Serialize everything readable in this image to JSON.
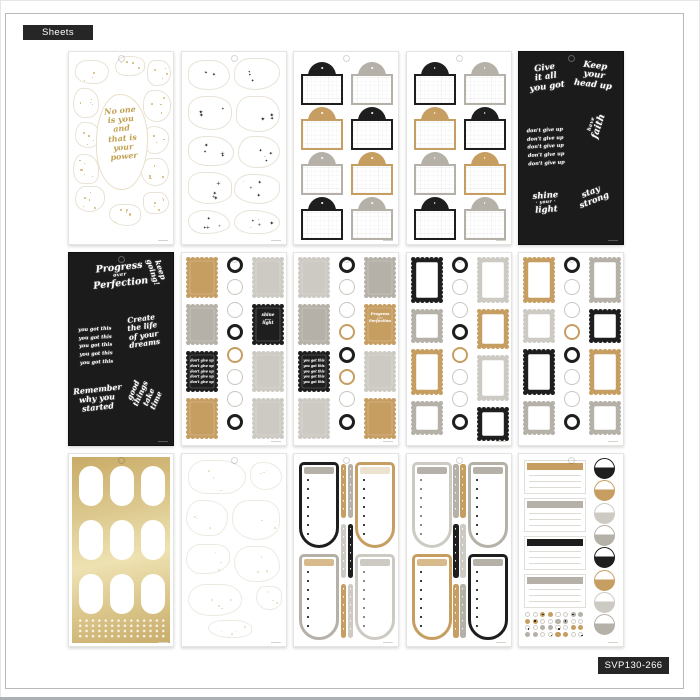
{
  "badges": {
    "sheets_label": "Sheets",
    "sku_label": "SVP130-266"
  },
  "colors": {
    "black": "#1e1e1e",
    "tan": "#c79e62",
    "gray": "#b5b1a8",
    "lightgray": "#cdcac3",
    "cream": "#ece2d0",
    "tanlight": "#d9ba8c",
    "gold_script": "#c2a150",
    "foil_light": "#eee2b2",
    "foil_dark": "#c9ab67",
    "badge_bg": "#262626"
  },
  "phrases": {
    "no_one_power": [
      "No one",
      "is you",
      "and",
      "that is",
      "your",
      "power"
    ],
    "give_it_all": [
      "Give",
      "it all",
      "you got"
    ],
    "keep_head_up": [
      "Keep",
      "your",
      "head up"
    ],
    "dont_give_up_5": [
      "don't give up",
      "don't give up",
      "don't give up",
      "don't give up",
      "don't give up"
    ],
    "have_faith": [
      "have",
      "faith"
    ],
    "shine_your_light": [
      "shine",
      "· your ·",
      "light"
    ],
    "stay_strong": [
      "stay",
      "strong"
    ],
    "progress_over_perfection": [
      "Progress",
      "over",
      "Perfection"
    ],
    "keep_going": [
      "keep",
      "going!"
    ],
    "you_got_this_5": [
      "you got this",
      "you got this",
      "you got this",
      "you got this",
      "you got this"
    ],
    "create_dreams": [
      "Create",
      "the life",
      "of your",
      "dreams"
    ],
    "remember_started": [
      "Remember",
      "why you",
      "started"
    ],
    "good_things": [
      "good things",
      "take time"
    ]
  },
  "sheets": [
    {
      "type": "quote-blobs",
      "quote": "no_one_power"
    },
    {
      "type": "sparkle-blobs"
    },
    {
      "type": "arch-labels",
      "cells": [
        [
          "black",
          "gray"
        ],
        [
          "tan",
          "black"
        ],
        [
          "gray",
          "tan"
        ],
        [
          "black",
          "gray"
        ]
      ]
    },
    {
      "type": "arch-labels",
      "cells": [
        [
          "black",
          "gray"
        ],
        [
          "tan",
          "black"
        ],
        [
          "gray",
          "tan"
        ],
        [
          "black",
          "gray"
        ]
      ]
    },
    {
      "type": "black-quotes",
      "quotes": [
        {
          "slot": "tl",
          "key": "give_it_all"
        },
        {
          "slot": "tr",
          "key": "keep_head_up"
        },
        {
          "slot": "ml",
          "key": "dont_give_up_5"
        },
        {
          "slot": "mr",
          "key": "have_faith"
        },
        {
          "slot": "bl",
          "key": "shine_your_light"
        },
        {
          "slot": "br",
          "key": "stay_strong"
        }
      ]
    },
    {
      "type": "black-quotes",
      "quotes": [
        {
          "slot": "top",
          "key": "progress_over_perfection"
        },
        {
          "slot": "tr",
          "key": "keep_going"
        },
        {
          "slot": "ml",
          "key": "you_got_this_5"
        },
        {
          "slot": "mr",
          "key": "create_dreams"
        },
        {
          "slot": "bl",
          "key": "remember_started"
        },
        {
          "slot": "br",
          "key": "good_things"
        }
      ]
    },
    {
      "type": "scallop",
      "left": [
        {
          "c": "tan"
        },
        {
          "c": "gray"
        },
        {
          "c": "black",
          "key": "dont_give_up_5"
        },
        {
          "c": "tan"
        }
      ],
      "circles": [
        "black",
        "white",
        "white",
        "black",
        "tan",
        "white",
        "white",
        "black"
      ],
      "right": [
        {
          "c": "lightgray"
        },
        {
          "c": "black",
          "key": "shine_your_light"
        },
        {
          "c": "lightgray"
        },
        {
          "c": "lightgray"
        }
      ]
    },
    {
      "type": "scallop",
      "left": [
        {
          "c": "lightgray"
        },
        {
          "c": "gray"
        },
        {
          "c": "black",
          "key": "you_got_this_5"
        },
        {
          "c": "lightgray"
        }
      ],
      "circles": [
        "black",
        "white",
        "white",
        "tan",
        "black",
        "tan",
        "white",
        "black"
      ],
      "right": [
        {
          "c": "gray"
        },
        {
          "c": "tan",
          "key": "progress_over_perfection"
        },
        {
          "c": "lightgray"
        },
        {
          "c": "tan"
        }
      ]
    },
    {
      "type": "scallop",
      "left": [
        {
          "c": "black",
          "style": "frame",
          "h": 46
        },
        {
          "c": "gray",
          "style": "frame",
          "h": 34
        },
        {
          "c": "tan",
          "style": "frame",
          "h": 46
        },
        {
          "c": "gray",
          "style": "frame",
          "h": 34
        }
      ],
      "circles": [
        "black",
        "white",
        "white",
        "black",
        "tan",
        "white",
        "white",
        "black"
      ],
      "right": [
        {
          "c": "lightgray",
          "style": "frame",
          "h": 46
        },
        {
          "c": "tan",
          "style": "frame",
          "h": 40
        },
        {
          "c": "lightgray",
          "style": "frame",
          "h": 46
        },
        {
          "c": "black",
          "style": "frame",
          "h": 34
        }
      ]
    },
    {
      "type": "scallop",
      "left": [
        {
          "c": "tan",
          "style": "frame",
          "h": 46
        },
        {
          "c": "lightgray",
          "style": "frame",
          "h": 34
        },
        {
          "c": "black",
          "style": "frame",
          "h": 46
        },
        {
          "c": "gray",
          "style": "frame",
          "h": 34
        }
      ],
      "circles": [
        "black",
        "white",
        "white",
        "tan",
        "black",
        "white",
        "white",
        "black"
      ],
      "right": [
        {
          "c": "gray",
          "style": "frame",
          "h": 46
        },
        {
          "c": "black",
          "style": "frame",
          "h": 34
        },
        {
          "c": "tan",
          "style": "frame",
          "h": 46
        },
        {
          "c": "gray",
          "style": "frame",
          "h": 34
        }
      ]
    },
    {
      "type": "gold-foil"
    },
    {
      "type": "faint-blobs"
    },
    {
      "type": "u-lists",
      "cells": [
        {
          "c": "black",
          "h": "gray"
        },
        {
          "c": "tan",
          "h": "cream"
        },
        {
          "c": "gray",
          "h": "tanlight"
        },
        {
          "c": "lightgray",
          "h": "lightgray"
        }
      ],
      "strips": [
        [
          "tan",
          "gray"
        ],
        [
          "lightgray",
          "black"
        ],
        [
          "tan",
          "lightgray"
        ]
      ]
    },
    {
      "type": "u-lists",
      "cells": [
        {
          "c": "lightgray",
          "h": "gray"
        },
        {
          "c": "gray",
          "h": "gray"
        },
        {
          "c": "tan",
          "h": "tanlight"
        },
        {
          "c": "black",
          "h": "gray"
        }
      ],
      "strips": [
        [
          "gray",
          "tan"
        ],
        [
          "black",
          "lightgray"
        ],
        [
          "tan",
          "gray"
        ]
      ]
    },
    {
      "type": "day-lists",
      "headers": [
        "tan",
        "gray",
        "black",
        "gray"
      ],
      "circles": [
        "black",
        "tan",
        "lightgray",
        "gray",
        "black",
        "tan",
        "lightgray",
        "gray"
      ]
    }
  ]
}
